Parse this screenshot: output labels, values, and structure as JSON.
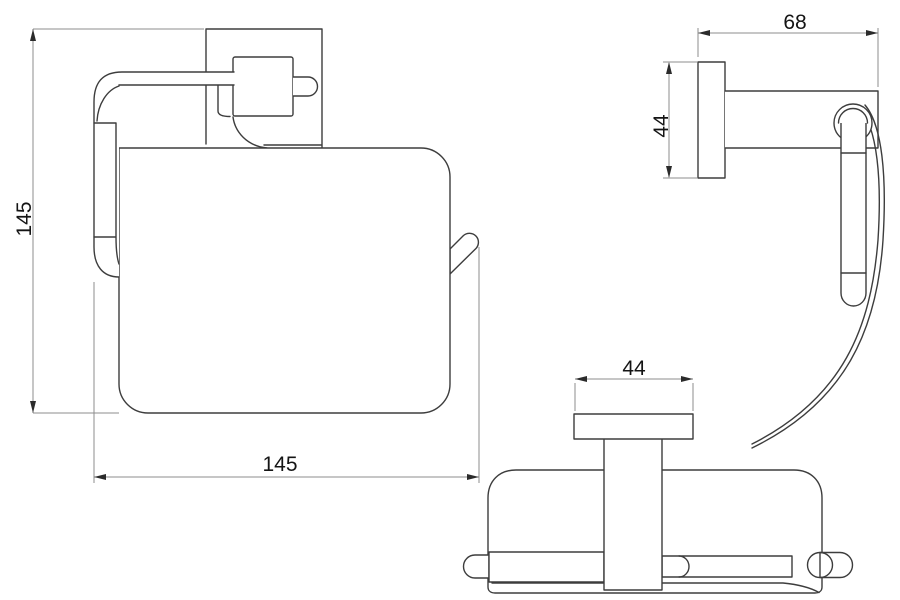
{
  "drawing": {
    "type": "technical-dimension-drawing",
    "subject": "wall-mounted toilet paper holder with cover, three orthographic views",
    "colors": {
      "background": "#ffffff",
      "object_line": "#3d3d3d",
      "dimension_line": "#8c8c8c",
      "text": "#141414"
    },
    "views": {
      "front": {
        "label": "front-view",
        "height_dim": "145",
        "width_dim": "145"
      },
      "side": {
        "label": "side-view",
        "depth_dim": "68",
        "plate_height_dim": "44"
      },
      "top": {
        "label": "top-view",
        "plate_width_dim": "44"
      }
    }
  }
}
